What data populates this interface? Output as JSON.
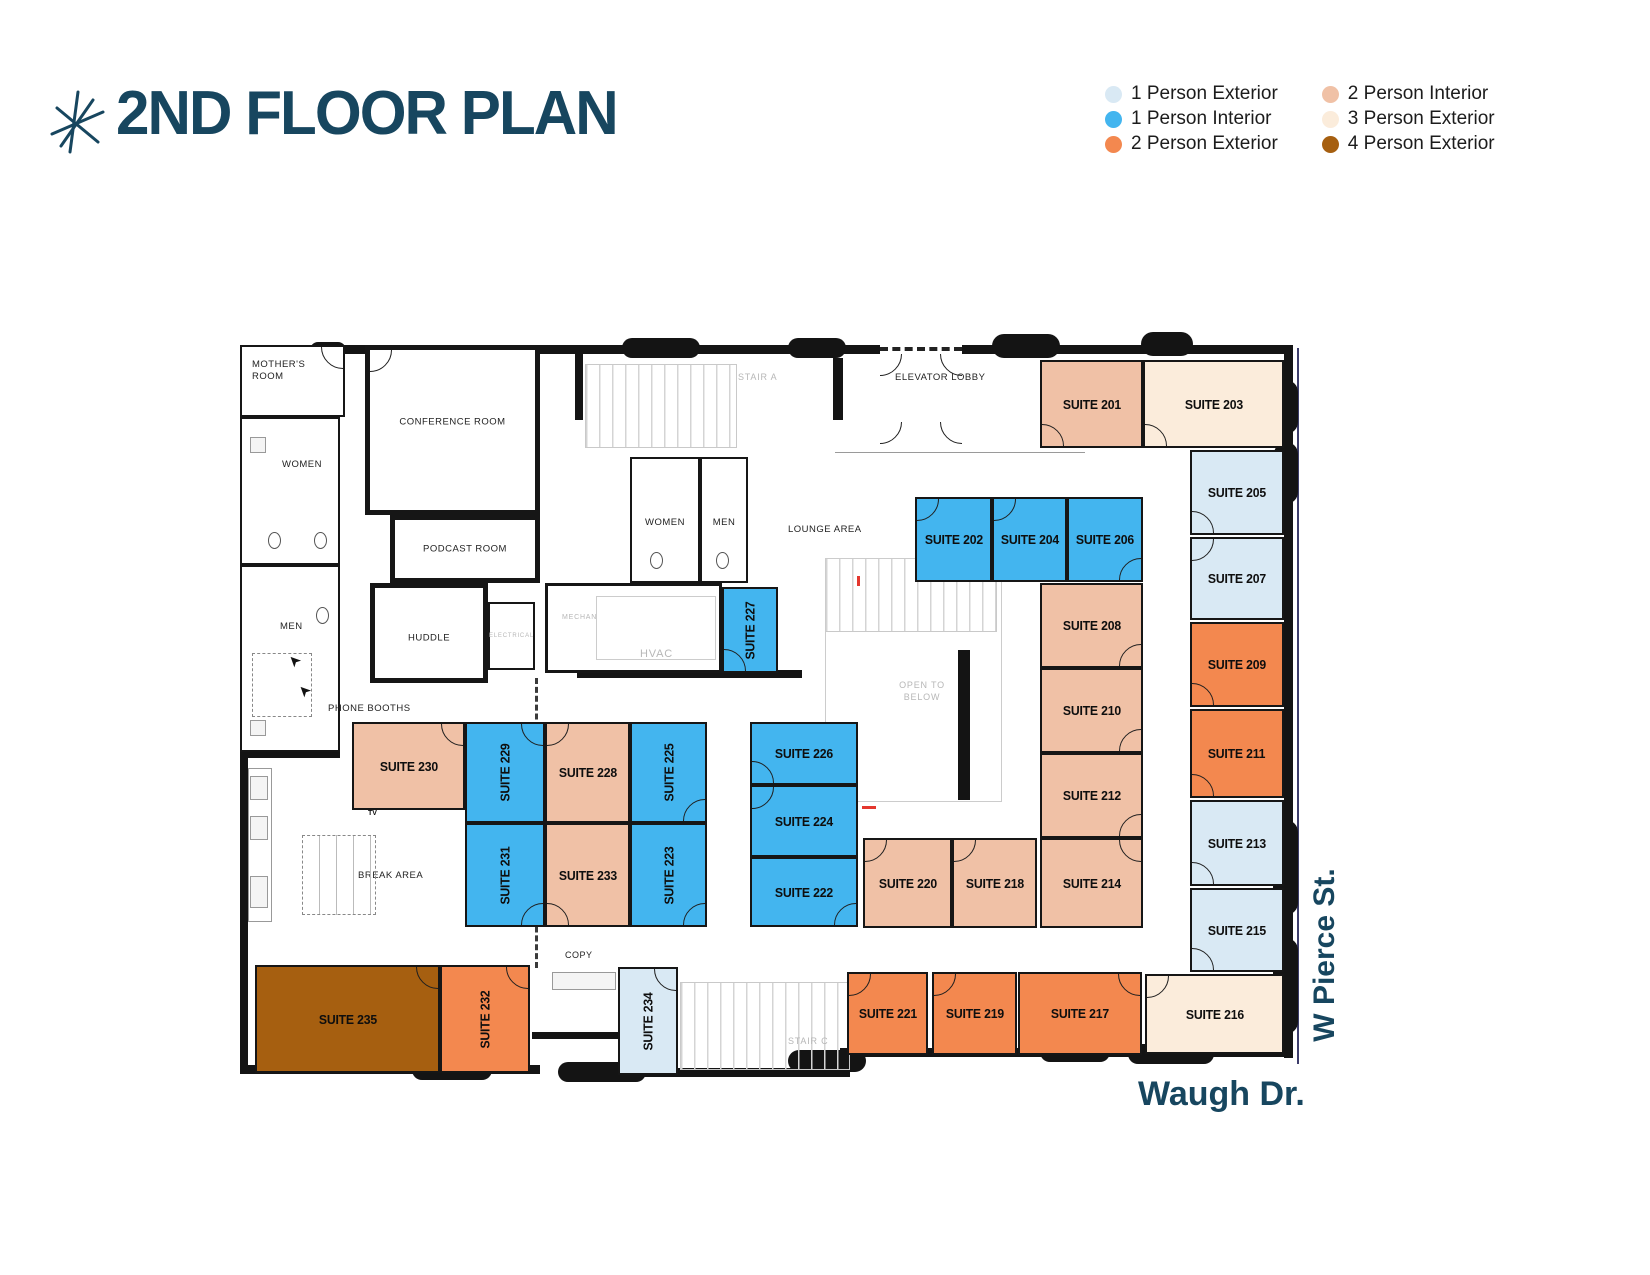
{
  "title": "2ND FLOOR PLAN",
  "colors": {
    "p1e": "#d9e9f4",
    "p1i": "#43b5ef",
    "p2e": "#f3884f",
    "p2i": "#f0c1a6",
    "p3e": "#fbecdb",
    "p4e": "#a65f10",
    "navy": "#17465f"
  },
  "legend": {
    "items": [
      {
        "label": "1 Person Exterior",
        "color": "#d9e9f4"
      },
      {
        "label": "1 Person Interior",
        "color": "#43b5ef"
      },
      {
        "label": "2 Person Exterior",
        "color": "#f3884f"
      },
      {
        "label": "2 Person Interior",
        "color": "#f0c1a6"
      },
      {
        "label": "3 Person Exterior",
        "color": "#fbecdb"
      },
      {
        "label": "4 Person Exterior",
        "color": "#a65f10"
      }
    ]
  },
  "streets": {
    "side": "W Pierce St.",
    "bottom": "Waugh Dr."
  },
  "suites": {
    "s201": "SUITE 201",
    "s202": "SUITE 202",
    "s203": "SUITE 203",
    "s204": "SUITE 204",
    "s205": "SUITE 205",
    "s206": "SUITE 206",
    "s207": "SUITE 207",
    "s208": "SUITE 208",
    "s209": "SUITE 209",
    "s210": "SUITE 210",
    "s211": "SUITE 211",
    "s212": "SUITE 212",
    "s213": "SUITE 213",
    "s214": "SUITE 214",
    "s215": "SUITE 215",
    "s216": "SUITE 216",
    "s217": "SUITE 217",
    "s218": "SUITE 218",
    "s219": "SUITE 219",
    "s220": "SUITE 220",
    "s221": "SUITE 221",
    "s222": "SUITE 222",
    "s223": "SUITE 223",
    "s224": "SUITE 224",
    "s225": "SUITE 225",
    "s226": "SUITE 226",
    "s227": "SUITE 227",
    "s228": "SUITE 228",
    "s229": "SUITE 229",
    "s230": "SUITE 230",
    "s231": "SUITE 231",
    "s232": "SUITE 232",
    "s233": "SUITE 233",
    "s234": "SUITE 234",
    "s235": "SUITE 235"
  },
  "areas": {
    "mothers_room": "MOTHER'S ROOM",
    "women": "WOMEN",
    "men": "MEN",
    "conference": "CONFERENCE ROOM",
    "podcast": "PODCAST ROOM",
    "huddle": "HUDDLE",
    "electrical": "ELECTRICAL",
    "mechanical": "MECHANICAL",
    "hvac": "HVAC",
    "stair_a": "STAIR A",
    "stair_c": "STAIR C",
    "elevator_lobby": "ELEVATOR LOBBY",
    "lounge": "LOUNGE AREA",
    "open_to_below": "OPEN TO BELOW",
    "phone_booths": "PHONE BOOTHS",
    "break_area": "BREAK AREA",
    "copy": "COPY",
    "tv": "TV"
  }
}
